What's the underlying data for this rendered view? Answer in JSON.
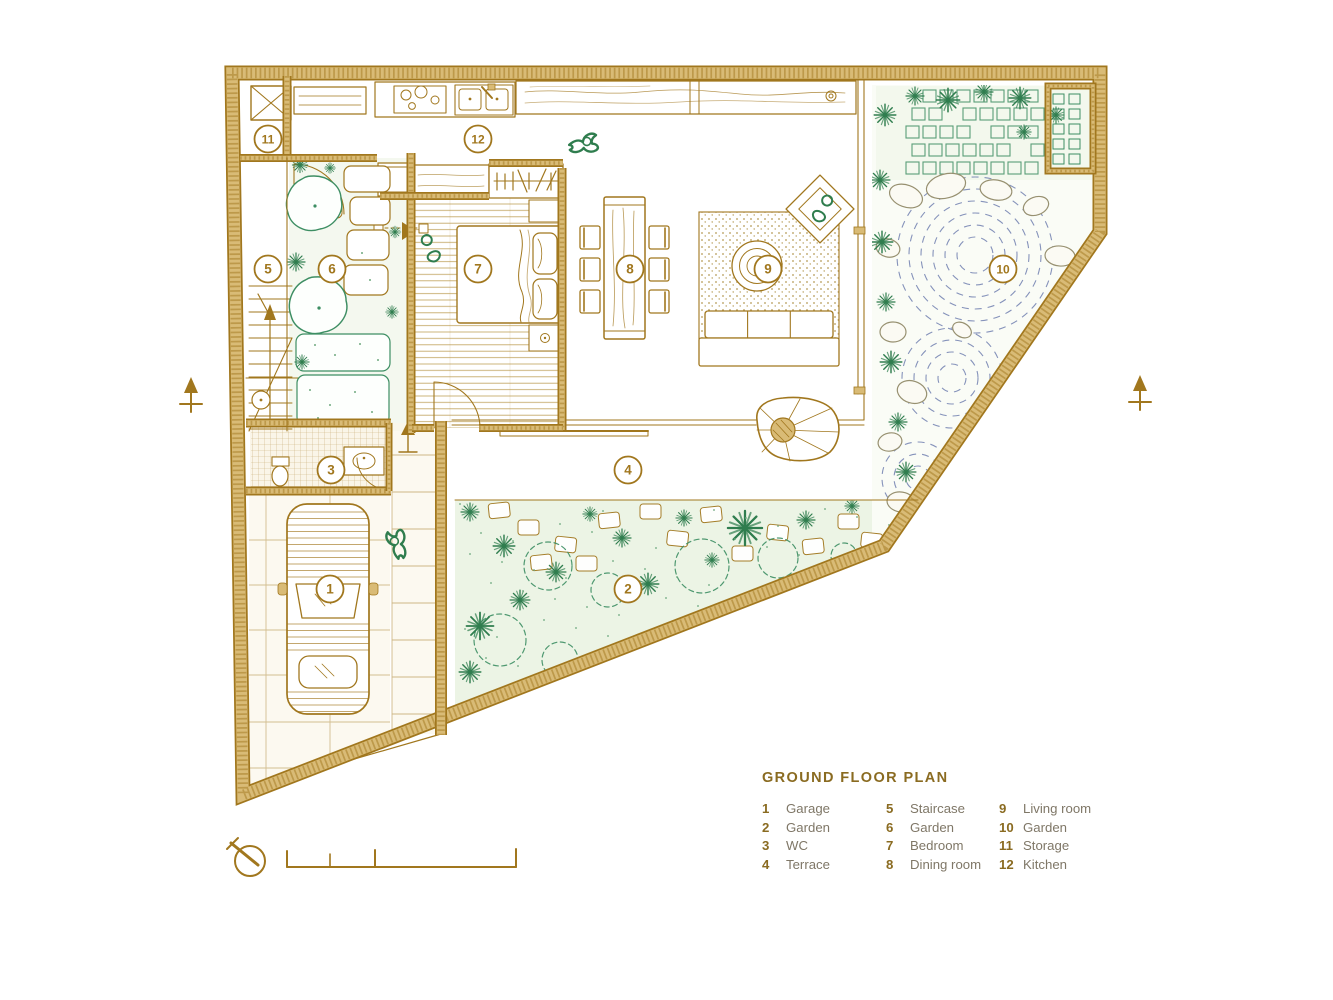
{
  "title": "GROUND FLOOR PLAN",
  "rooms": [
    {
      "num": "1",
      "label": "Garage",
      "x": 330,
      "y": 589
    },
    {
      "num": "2",
      "label": "Garden",
      "x": 628,
      "y": 589
    },
    {
      "num": "3",
      "label": "WC",
      "x": 331,
      "y": 470
    },
    {
      "num": "4",
      "label": "Terrace",
      "x": 628,
      "y": 470
    },
    {
      "num": "5",
      "label": "Staircase",
      "x": 268,
      "y": 269
    },
    {
      "num": "6",
      "label": "Garden",
      "x": 332,
      "y": 269
    },
    {
      "num": "7",
      "label": "Bedroom",
      "x": 478,
      "y": 269
    },
    {
      "num": "8",
      "label": "Dining room",
      "x": 630,
      "y": 269
    },
    {
      "num": "9",
      "label": "Living room",
      "x": 768,
      "y": 269
    },
    {
      "num": "10",
      "label": "Garden",
      "x": 1003,
      "y": 269
    },
    {
      "num": "11",
      "label": "Storage",
      "x": 268,
      "y": 139
    },
    {
      "num": "12",
      "label": "Kitchen",
      "x": 478,
      "y": 139
    }
  ],
  "colors": {
    "ink": "#A1771E",
    "tan": "#D9BB76",
    "teal": "#3D8E63",
    "green": "#4E9A63",
    "blue": "#7886B4",
    "stone": "#979070",
    "wash": "#ECF4E5",
    "accent": "#8A6B21",
    "label": "#7F7767"
  }
}
